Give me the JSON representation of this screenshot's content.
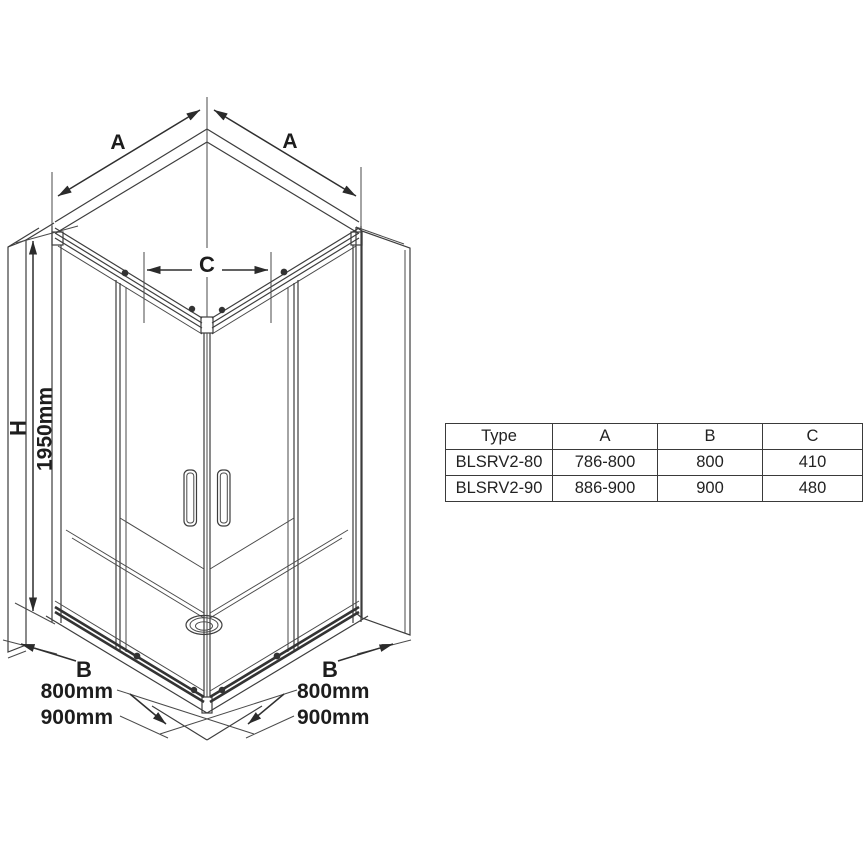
{
  "drawing": {
    "dim_a_left": "A",
    "dim_a_right": "A",
    "dim_c": "C",
    "dim_h": "H",
    "dim_h_value": "1950mm",
    "dim_b_left": "B",
    "dim_b_right": "B",
    "width_800_left": "800mm",
    "width_900_left": "900mm",
    "width_800_right": "800mm",
    "width_900_right": "900mm"
  },
  "spec_table": {
    "columns": [
      "Type",
      "A",
      "B",
      "C"
    ],
    "rows": [
      [
        "BLSRV2-80",
        "786-800",
        "800",
        "410"
      ],
      [
        "BLSRV2-90",
        "886-900",
        "900",
        "480"
      ]
    ]
  },
  "colors": {
    "line": "#3d3d3d",
    "background": "#ffffff"
  }
}
